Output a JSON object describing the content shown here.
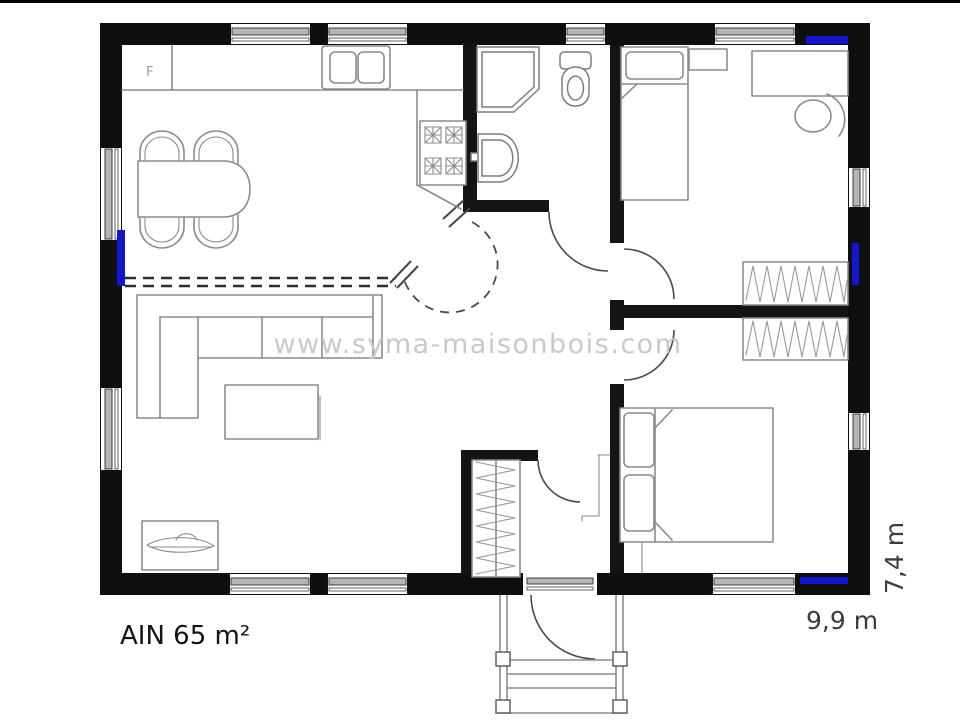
{
  "plan": {
    "area_label": "AIN 65 m²",
    "width_label": "9,9 m",
    "depth_label": "7,4 m",
    "fridge_label": "F",
    "watermark": "www.syma-maisonbois.com"
  },
  "colors": {
    "wall_black": "#0f0f0f",
    "window_highlight_blue": "#1515cf",
    "window_frame_gray": "#b5b5b5",
    "furniture_line_gray": "#8b8b8b",
    "watermark_gray": "#c9c9c9",
    "dimension_text_gray": "#3c3c3c",
    "area_text_black": "#141414",
    "fridge_label_gray_blue": "#8fa0ad"
  },
  "symbols": [
    "fridge",
    "kitchen-sink",
    "cooktop",
    "kitchen-counter",
    "dining-table",
    "dining-chair",
    "corner-sofa",
    "coffee-table",
    "tv-cabinet",
    "shower",
    "toilet",
    "washbasin",
    "single-bed",
    "double-bed",
    "nightstand",
    "desk",
    "desk-chair",
    "wardrobe",
    "entry-closet",
    "entrance-door",
    "porch-steps",
    "window",
    "door-swing"
  ]
}
